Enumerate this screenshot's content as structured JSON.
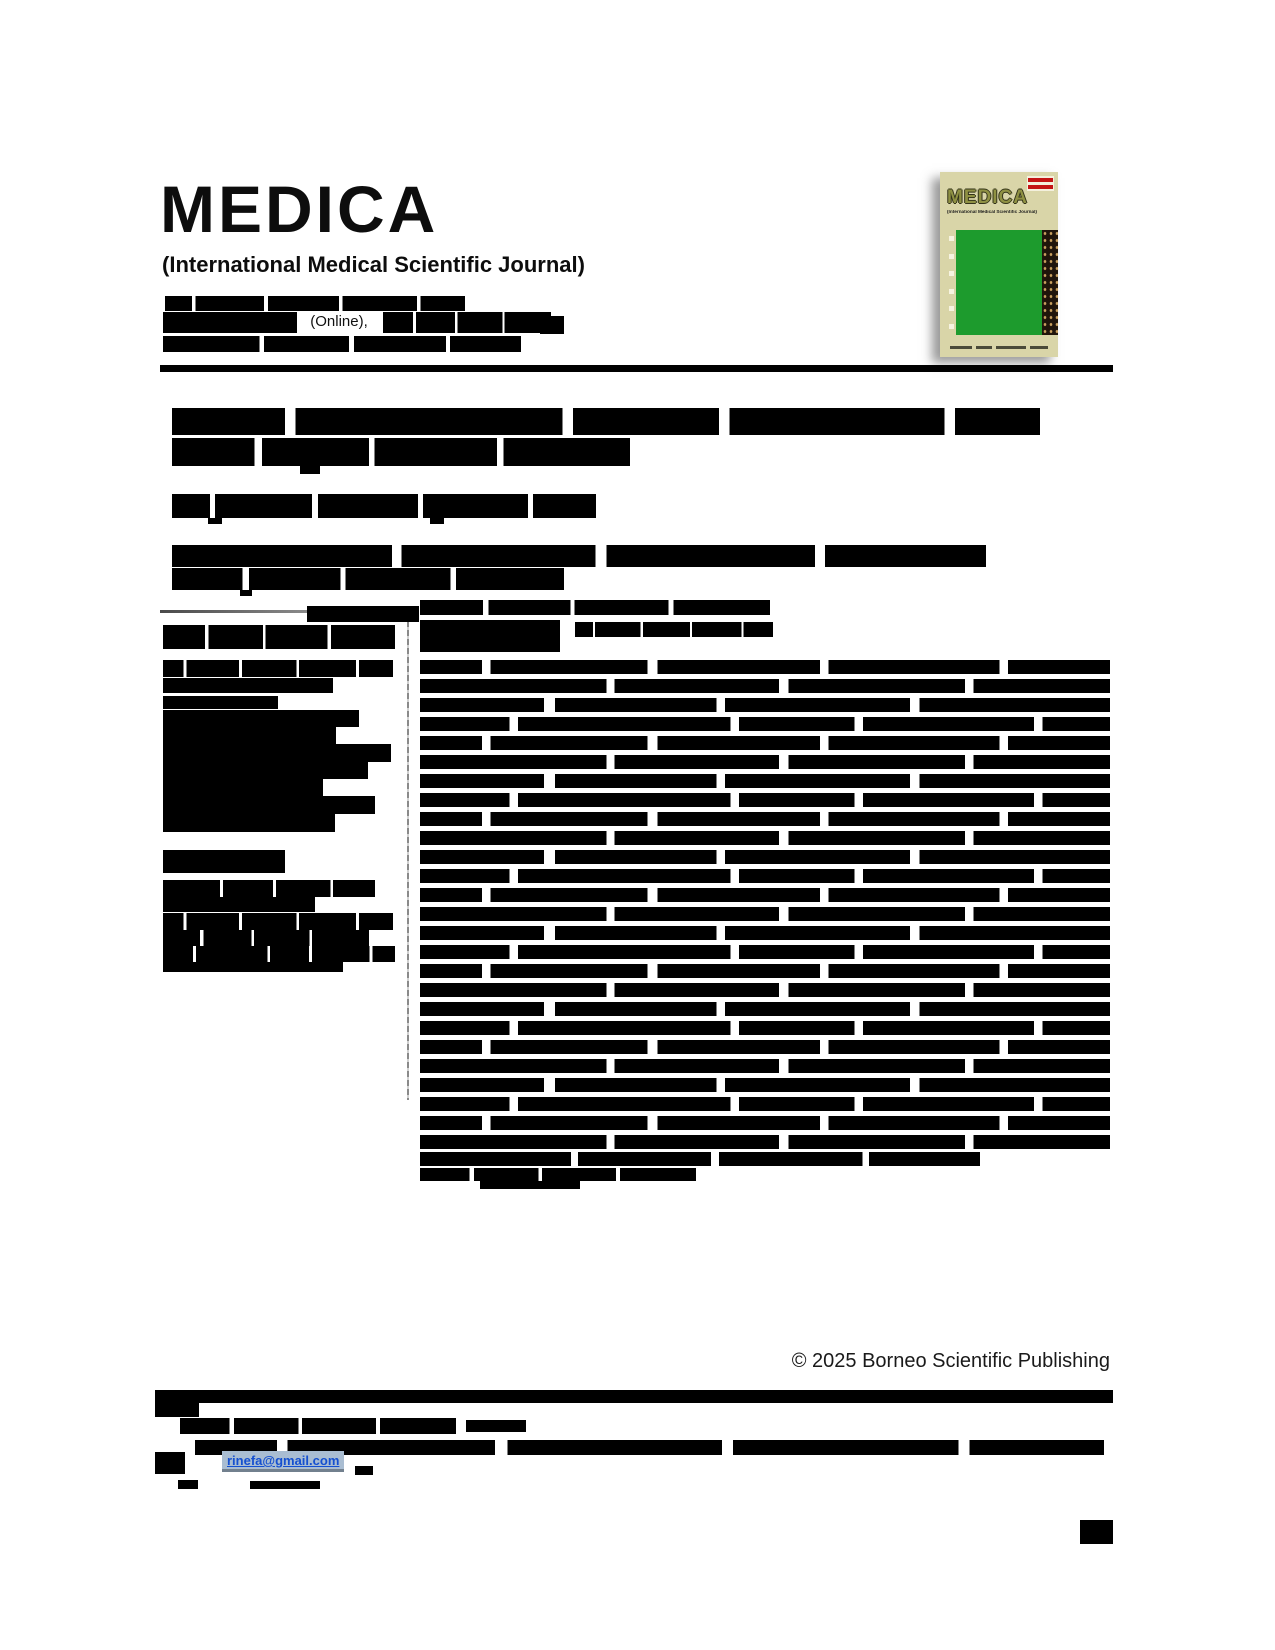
{
  "journal": {
    "title": "MEDICA",
    "subtitle": "(International Medical Scientific Journal)",
    "issn_visible": "(Online),"
  },
  "cover": {
    "title": "MEDICA",
    "subtitle": "(International Medical Scientific Journal)",
    "colors": {
      "background": "#d9d5a8",
      "panel_green": "#1d9b2d",
      "issn_red": "#c41414",
      "batik_brown": "#20150b"
    }
  },
  "footer": {
    "copyright": "© 2025 Borneo Scientific Publishing",
    "email": "rinefa@gmail.com"
  },
  "accent_colors": {
    "link_blue": "#1550d0",
    "link_highlight": "#a9bdd2"
  }
}
